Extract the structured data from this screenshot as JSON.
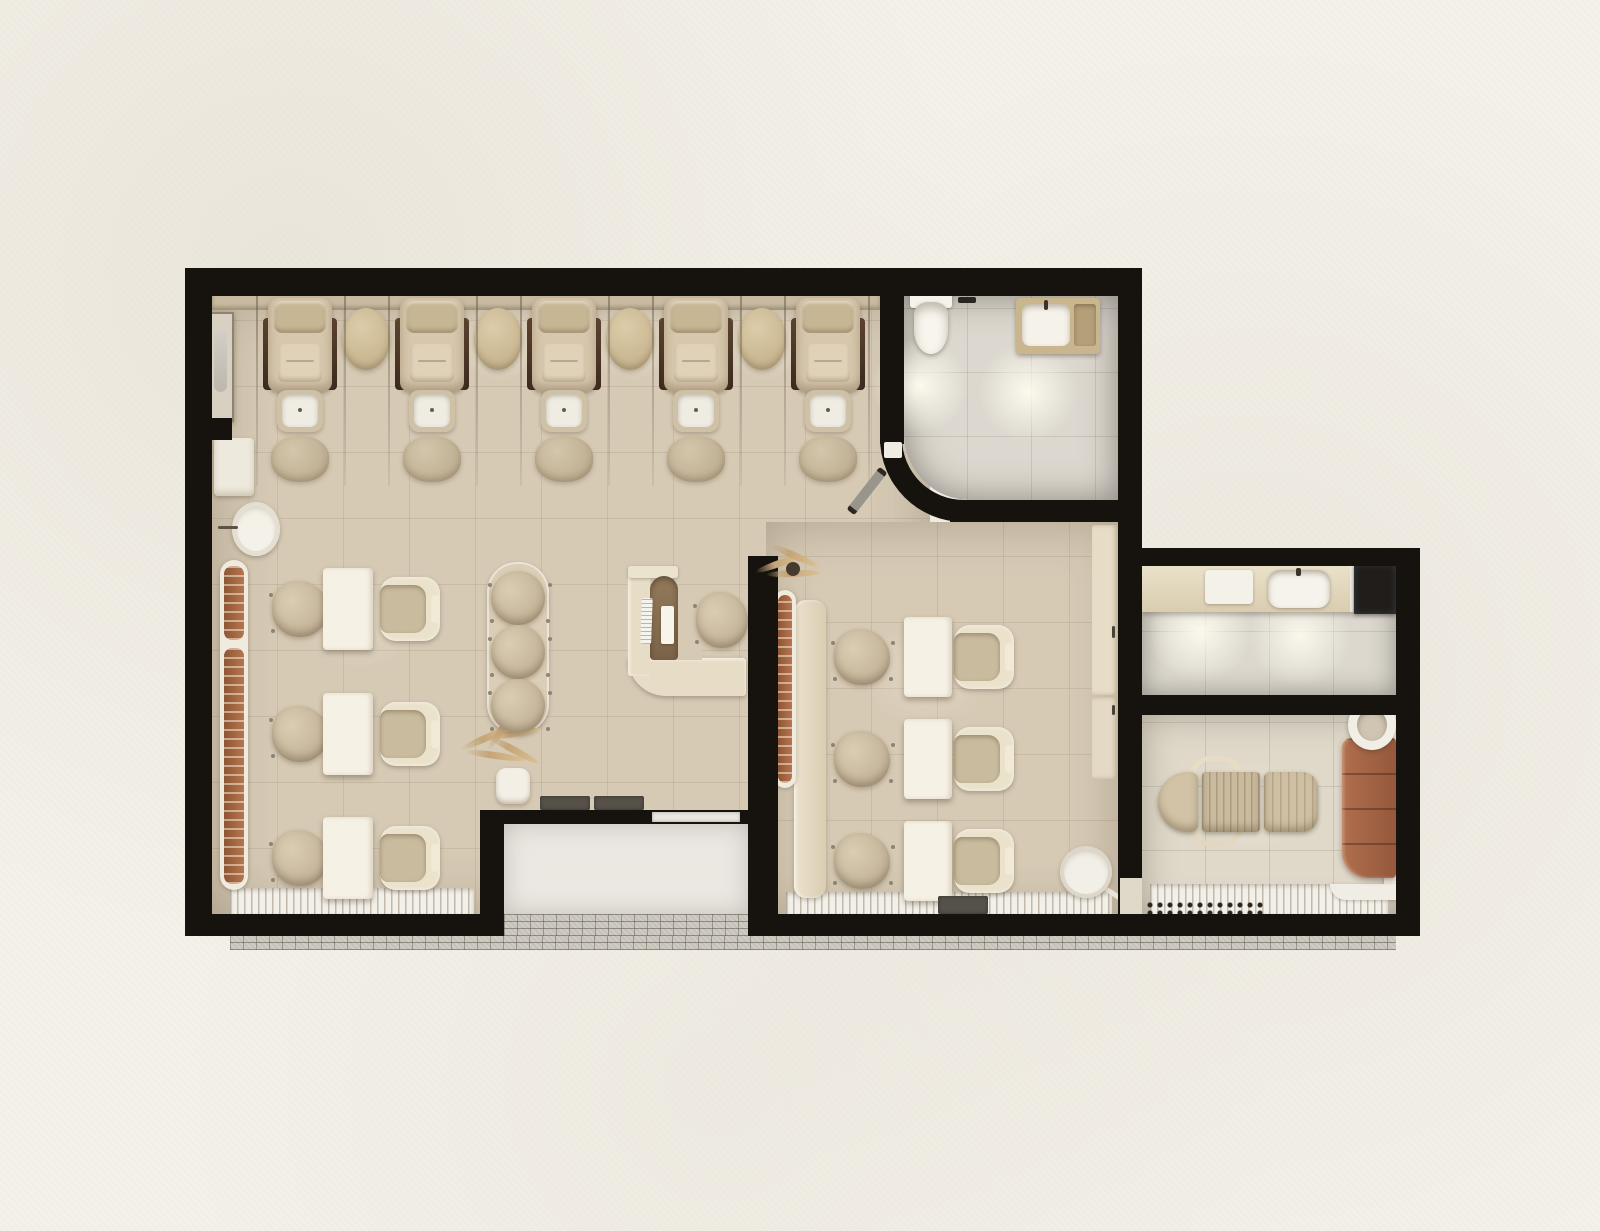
{
  "scene": {
    "type": "floor-plan",
    "subject": "nail-and-beauty salon interior, photorealistic top-down 3D render on textured paper background"
  },
  "palette": {
    "page": "#f4f1ea",
    "wall": "#16120e",
    "floor": "#d6cab5",
    "floorlight": "#dcd8cf",
    "floorwarm": "#e0d9ca",
    "alcove": "#ebe8e2",
    "cream": "#e8dec8",
    "white": "#f4f0e6",
    "uph": "#d2c3a7",
    "boucle": "#c8ba9e",
    "wood": "#4e382a",
    "copper": "#a0613c",
    "terra": "#a76a4e",
    "slat": "#f2f0e9",
    "mosaic": "#c7c3ba",
    "mat": "#56524a"
  },
  "rooms": [
    {
      "id": "pedicure-lounge",
      "items": [
        "pedicure-chair x5",
        "foot-basin x5",
        "ottoman x5",
        "oval-side-table x4",
        "glass-divider x10",
        "mirror-panel"
      ]
    },
    {
      "id": "restroom",
      "items": [
        "toilet",
        "vanity-sink",
        "curved-wall",
        "swing-door"
      ]
    },
    {
      "id": "styling-area-left",
      "items": [
        "manicure-table x3",
        "client-chair x3",
        "stylist-chair x3",
        "retail-shelf",
        "wall-sink",
        "wall-cabinet",
        "round-stool x3",
        "dried-plant"
      ]
    },
    {
      "id": "reception",
      "items": [
        "l-shaped-desk",
        "keyboard",
        "notepad",
        "boucle-stool"
      ]
    },
    {
      "id": "nail-stations-right",
      "items": [
        "manicure-table x3",
        "client-chair x3",
        "tech-chair x3",
        "retail-shelf",
        "bench",
        "plant",
        "storage-cabinet",
        "sliding-door",
        "laundry-basket",
        "doormat"
      ]
    },
    {
      "id": "kitchenette",
      "items": [
        "counter",
        "sink",
        "cutting-board",
        "cooktop"
      ]
    },
    {
      "id": "treatment-room",
      "items": [
        "massage-bed",
        "stool-arc x2",
        "terracotta-cabinet",
        "round-basin",
        "side-ledge",
        "pebble-strip"
      ]
    },
    {
      "id": "entrance-alcove",
      "items": [
        "doormat x2",
        "glass-door",
        "mosaic-paving"
      ]
    }
  ]
}
